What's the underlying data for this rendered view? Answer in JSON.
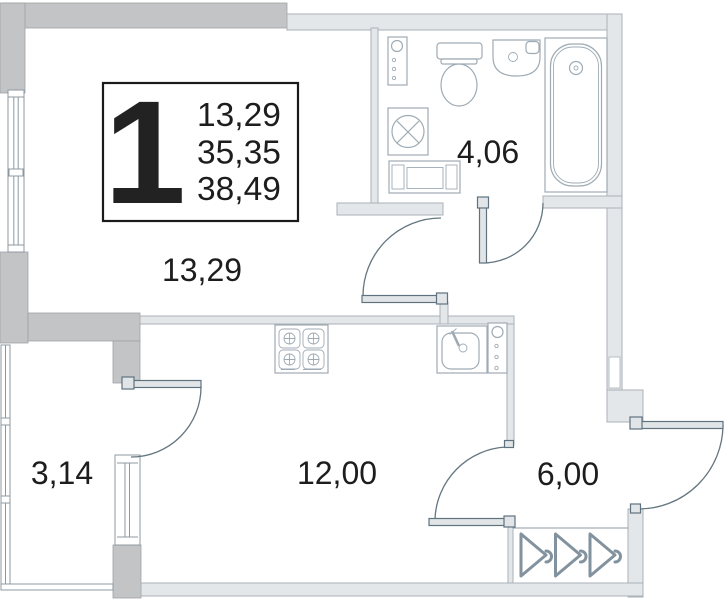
{
  "plan": {
    "legend": {
      "number": "1",
      "values": [
        "13,29",
        "35,35",
        "38,49"
      ]
    },
    "rooms": [
      {
        "id": "living-room",
        "area": "13,29"
      },
      {
        "id": "bathroom",
        "area": "4,06"
      },
      {
        "id": "balcony",
        "area": "3,14"
      },
      {
        "id": "kitchen",
        "area": "12,00"
      },
      {
        "id": "hallway",
        "area": "6,00"
      }
    ],
    "fixtures": [
      "bathtub-icon",
      "toilet-icon",
      "washbasin-icon",
      "washing-machine-icon",
      "plumbing-riser-icon",
      "bathroom-cabinet-icon",
      "stove-icon",
      "kitchen-sink-icon",
      "kitchen-riser-icon",
      "coat-hanger-icon",
      "window-icon",
      "door-swing-icon"
    ],
    "colors": {
      "wall-dark": "#c2c4c6",
      "wall-dark-stroke": "#9fa2a5",
      "wall-light": "#e4e7e9",
      "wall-stroke": "#a8b1b8",
      "fixture": "#9fabb4",
      "leaf-fill": "#e2e5e7",
      "leaf-stroke": "#5f7280",
      "arc": "#64767f",
      "window": "#8d99a2",
      "hanger": "#82929e",
      "text": "#1d1d1d",
      "box-stroke": "#1a1a1a",
      "bg": "#ffffff"
    }
  }
}
